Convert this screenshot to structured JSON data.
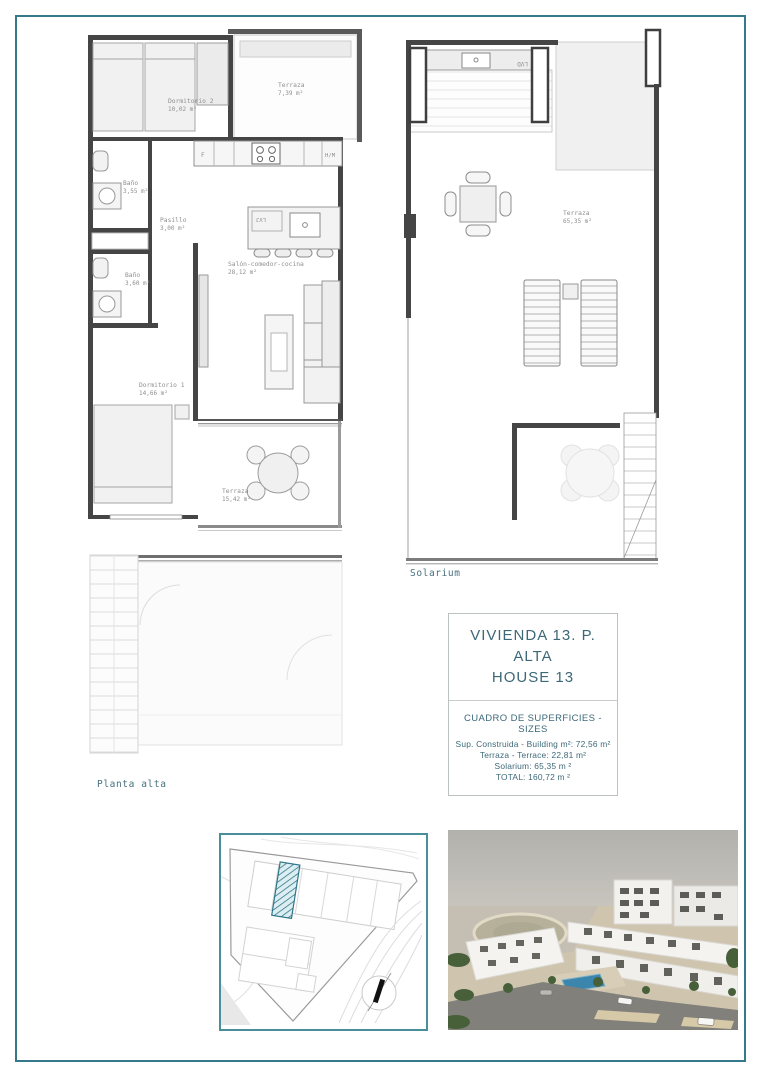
{
  "colors": {
    "frame_teal": "#35798a",
    "accent_teal": "#3c6878",
    "site_border_teal": "#4a8d9b",
    "hatch_teal": "#2f7788",
    "pool_blue": "#3c85ac"
  },
  "plan_alta": {
    "caption": "Planta alta",
    "rooms": {
      "dormitorio2": {
        "name": "Dormitorio 2",
        "area": "10,02 m²"
      },
      "terraza_top": {
        "name": "Terraza",
        "area": "7,39 m²"
      },
      "bano_355": {
        "name": "Baño",
        "area": "3,55 m²"
      },
      "pasillo": {
        "name": "Pasillo",
        "area": "3,00 m²"
      },
      "bano_360": {
        "name": "Baño",
        "area": "3,60 m²"
      },
      "dormitorio1": {
        "name": "Dormitorio 1",
        "area": "14,66 m²"
      },
      "salon": {
        "name": "Salón-comedor-cocina",
        "area": "28,12 m²"
      },
      "terraza_bottom": {
        "name": "Terraza",
        "area": "15,42 m²"
      }
    },
    "appliances": {
      "fridge": "F",
      "oven_microwave": "H/M",
      "dishwasher": "LVJ"
    }
  },
  "plan_solarium": {
    "caption": "Solarium",
    "terraza": {
      "name": "Terraza",
      "area": "65,35 m²"
    },
    "appliances": {
      "laundry": "LVD"
    }
  },
  "info_box": {
    "title_line1": "VIVIENDA 13. P. ALTA",
    "title_line2": "HOUSE 13",
    "table_heading": "CUADRO DE SUPERFICIES  - SIZES",
    "rows": [
      "Sup. Construida  - Building m²: 72,56 m²",
      "Terraza - Terrace: 22,81 m²",
      "Solarium: 65,35 m ²",
      "TOTAL:  160,72 m ²"
    ]
  }
}
